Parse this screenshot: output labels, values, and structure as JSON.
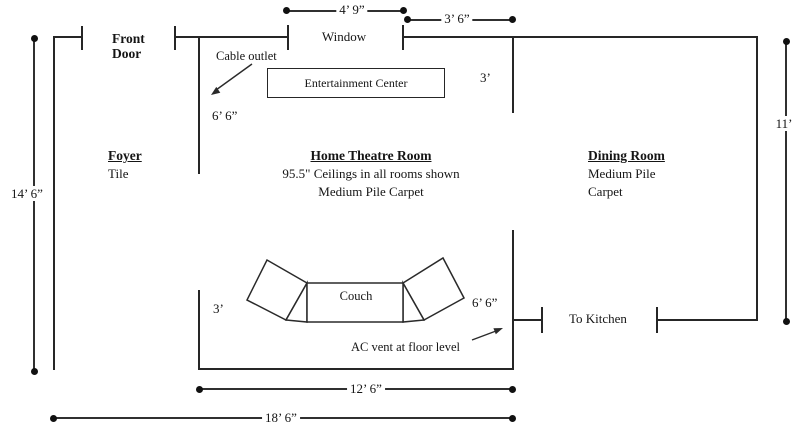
{
  "colors": {
    "line": "#262626",
    "background": "#ffffff",
    "text": "#151515"
  },
  "doors": {
    "front_door_line1": "Front",
    "front_door_line2": "Door",
    "to_kitchen": "To Kitchen"
  },
  "window": {
    "label": "Window",
    "width_dim": "4’ 9”",
    "offset_dim": "3’ 6”"
  },
  "foyer": {
    "title": "Foyer",
    "floor": "Tile"
  },
  "theatre": {
    "title": "Home Theatre Room",
    "ceiling_note": "95.5\" Ceilings in all rooms shown",
    "floor_note": "Medium Pile Carpet",
    "cable_outlet": "Cable outlet",
    "entertainment_center": "Entertainment Center",
    "couch": "Couch",
    "ac_vent_note": "AC vent at floor level",
    "left_wall_upper_dim": "6’ 6”",
    "left_wall_lower_dim": "3’",
    "right_wall_upper_dim": "3’",
    "right_wall_lower_dim": "6’ 6”",
    "width_dim": "12’ 6”"
  },
  "dining": {
    "title": "Dining Room",
    "floor_line1": "Medium Pile",
    "floor_line2": "Carpet",
    "height_dim": "11’"
  },
  "overall": {
    "height_dim": "14’ 6”",
    "width_dim": "18’ 6”"
  }
}
